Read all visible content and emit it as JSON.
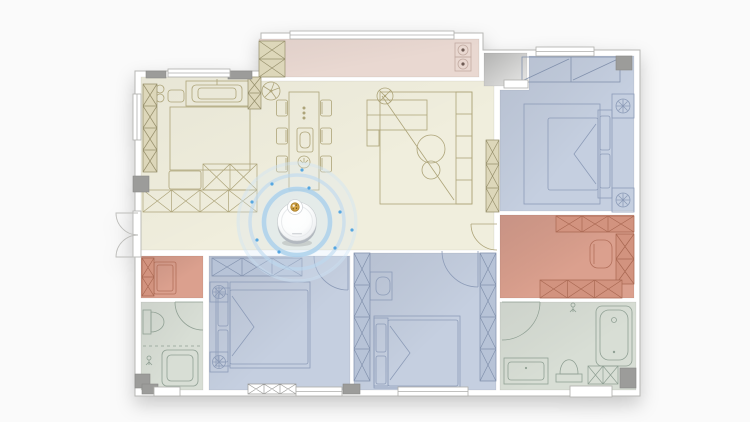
{
  "scene": {
    "type": "apartment-floor-plan-with-robot-vacuum",
    "background": "#fafafa"
  },
  "palette": {
    "wall_fill": "#ffffff",
    "wall_outline": "#b7b7b4",
    "wall_block": "#9c9c9a",
    "cream_fill": "#f0eedd",
    "cream_line": "#ada479",
    "balcony_fill": "#e9d8d1",
    "balcony_line": "#c2aba2",
    "blue_fill": "#c5cfe0",
    "blue_line": "#8d9cb8",
    "blue_cabinet_fill": "#b7c3d7",
    "pink_fill": "#dba08e",
    "pink_line": "#b3705b",
    "pink_cabinet_fill": "#d2937f",
    "bath_fill": "#d8ded5",
    "bath_line": "#90a094",
    "khaki_cabinet_fill": "#ddd7ba",
    "khaki_cabinet_line": "#97906c",
    "vestibule_dark": "#b9b9b8",
    "vestibule_light": "#e8e8e7",
    "robot_body": "#ffffff",
    "robot_band": "#b2b8bf",
    "robot_ring_inner": "#a9cfeb",
    "robot_ring_mid": "#bcd9f0",
    "robot_ring_outer": "#cfe4f6",
    "robot_glow": "#d7e9f7",
    "robot_dot": "#47a0e0",
    "robot_lens": "#d3a344"
  },
  "rooms": [
    {
      "id": "living-dining-kitchen",
      "shape": "polygon",
      "points": "141,77 257,77 257,81 494,81 494,250 141,250",
      "fill": "cream",
      "shade": 0.22,
      "interactable": true
    },
    {
      "id": "balcony",
      "shape": "rect",
      "x": 259,
      "y": 39,
      "w": 220,
      "h": 38,
      "fill": "balcony",
      "shade": 0.25,
      "interactable": true
    },
    {
      "id": "entry-vestibule",
      "shape": "rect",
      "x": 484,
      "y": 53,
      "w": 43,
      "h": 33,
      "fill": "vestibule",
      "shade": 0,
      "interactable": true
    },
    {
      "id": "bedroom-top-right",
      "shape": "polygon",
      "points": "500,90 529,90 529,56 634,56 634,211 500,211",
      "fill": "blue",
      "shade": 0.5,
      "interactable": true
    },
    {
      "id": "walk-in-closet",
      "shape": "rect",
      "x": 500,
      "y": 215,
      "w": 134,
      "h": 83,
      "fill": "pink",
      "shade": 0.6,
      "interactable": true
    },
    {
      "id": "bathroom-right",
      "shape": "rect",
      "x": 500,
      "y": 302,
      "w": 136,
      "h": 88,
      "fill": "bath",
      "shade": 0.35,
      "interactable": true
    },
    {
      "id": "bedroom-bottom-middle",
      "shape": "rect",
      "x": 354,
      "y": 253,
      "w": 142,
      "h": 137,
      "fill": "blue",
      "shade": 0.5,
      "interactable": true
    },
    {
      "id": "bedroom-bottom-left",
      "shape": "rect",
      "x": 209,
      "y": 256,
      "w": 141,
      "h": 134,
      "fill": "blue",
      "shade": 0.5,
      "interactable": true
    },
    {
      "id": "cloakroom-left",
      "shape": "rect",
      "x": 141,
      "y": 256,
      "w": 62,
      "h": 42,
      "fill": "pink",
      "shade": 0.6,
      "interactable": true
    },
    {
      "id": "bathroom-left",
      "shape": "rect",
      "x": 141,
      "y": 302,
      "w": 62,
      "h": 88,
      "fill": "bath",
      "shade": 0.35,
      "interactable": true
    }
  ],
  "robot": {
    "x": 297,
    "y": 222,
    "body_radius": 19.5,
    "sensor_dx": -2,
    "sensor_dy": -15,
    "rings": [
      33,
      47,
      59
    ],
    "dots": [
      [
        -45,
        -20
      ],
      [
        -25,
        -38
      ],
      [
        12,
        -34
      ],
      [
        43,
        -10
      ],
      [
        38,
        26
      ],
      [
        -18,
        30
      ],
      [
        -40,
        18
      ],
      [
        55,
        8
      ],
      [
        5,
        -52
      ]
    ]
  }
}
